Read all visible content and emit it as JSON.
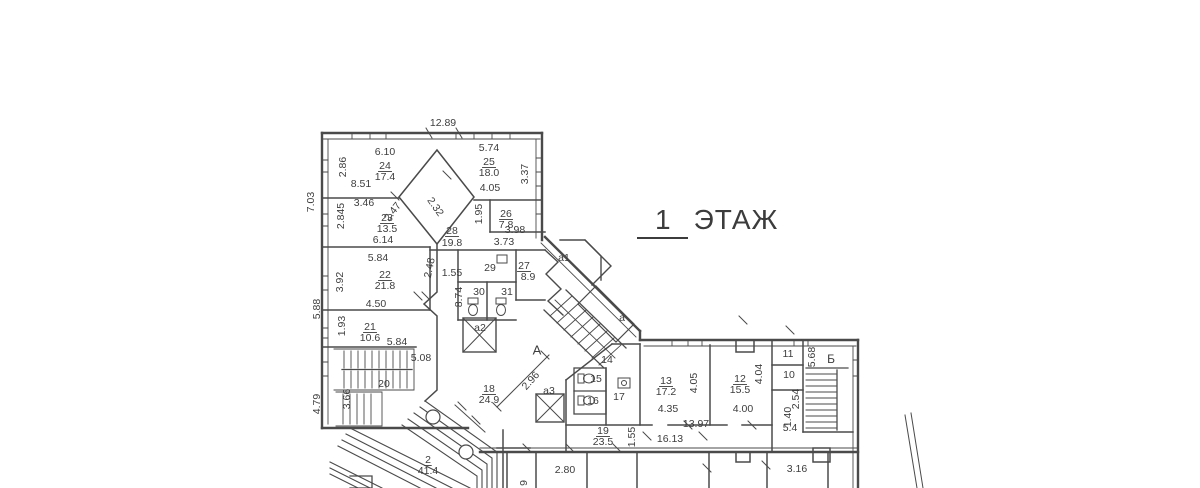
{
  "title": {
    "number": "1",
    "word": "ЭТАЖ"
  },
  "plan": {
    "ink": "#3d3d3d",
    "wall_color": "#4a4a4a",
    "labels": [
      {
        "t": "12.89",
        "x": 443,
        "y": 123
      },
      {
        "t": "6.10",
        "x": 385,
        "y": 152
      },
      {
        "t": "24",
        "x": 385,
        "y": 166,
        "u": 1
      },
      {
        "t": "17.4",
        "x": 385,
        "y": 177
      },
      {
        "t": "2.86",
        "x": 343,
        "y": 167,
        "r": -90
      },
      {
        "t": "8.51",
        "x": 361,
        "y": 184
      },
      {
        "t": "3.46",
        "x": 364,
        "y": 203
      },
      {
        "t": "2.845",
        "x": 341,
        "y": 216,
        "r": -90
      },
      {
        "t": "23",
        "x": 387,
        "y": 218,
        "u": 1
      },
      {
        "t": "13.5",
        "x": 387,
        "y": 229
      },
      {
        "t": "6.14",
        "x": 383,
        "y": 240
      },
      {
        "t": "7.03",
        "x": 311,
        "y": 202,
        "r": -90
      },
      {
        "t": "5.74",
        "x": 489,
        "y": 148
      },
      {
        "t": "25",
        "x": 489,
        "y": 162,
        "u": 1
      },
      {
        "t": "18.0",
        "x": 489,
        "y": 173
      },
      {
        "t": "4.05",
        "x": 490,
        "y": 188
      },
      {
        "t": "3.37",
        "x": 525,
        "y": 174,
        "r": -90
      },
      {
        "t": "2.47",
        "x": 393,
        "y": 212,
        "r": -52
      },
      {
        "t": "2.32",
        "x": 435,
        "y": 207,
        "r": 55
      },
      {
        "t": "1.95",
        "x": 479,
        "y": 214,
        "r": -90
      },
      {
        "t": "26",
        "x": 506,
        "y": 214,
        "u": 1
      },
      {
        "t": "7.8",
        "x": 506,
        "y": 225
      },
      {
        "t": "3.98",
        "x": 515,
        "y": 230
      },
      {
        "t": "28",
        "x": 452,
        "y": 231,
        "u": 1
      },
      {
        "t": "19.8",
        "x": 452,
        "y": 243
      },
      {
        "t": "3.73",
        "x": 504,
        "y": 242
      },
      {
        "t": "5.84",
        "x": 378,
        "y": 258
      },
      {
        "t": "3.92",
        "x": 340,
        "y": 282,
        "r": -90
      },
      {
        "t": "22",
        "x": 385,
        "y": 275,
        "u": 1
      },
      {
        "t": "21.8",
        "x": 385,
        "y": 286
      },
      {
        "t": "2.48",
        "x": 430,
        "y": 268,
        "r": -78
      },
      {
        "t": "1.55",
        "x": 452,
        "y": 273
      },
      {
        "t": "29",
        "x": 490,
        "y": 268
      },
      {
        "t": "27",
        "x": 524,
        "y": 266,
        "u": 1
      },
      {
        "t": "8.9",
        "x": 528,
        "y": 277
      },
      {
        "t": "30",
        "x": 479,
        "y": 292
      },
      {
        "t": "31",
        "x": 507,
        "y": 292
      },
      {
        "t": "8.74",
        "x": 459,
        "y": 297,
        "r": -90
      },
      {
        "t": "а1",
        "x": 564,
        "y": 258
      },
      {
        "t": "4.50",
        "x": 376,
        "y": 304
      },
      {
        "t": "5.88",
        "x": 317,
        "y": 309,
        "r": -90
      },
      {
        "t": "1.93",
        "x": 342,
        "y": 326,
        "r": -90
      },
      {
        "t": "21",
        "x": 370,
        "y": 327,
        "u": 1
      },
      {
        "t": "10.6",
        "x": 370,
        "y": 338
      },
      {
        "t": "5.84",
        "x": 397,
        "y": 342
      },
      {
        "t": "а2",
        "x": 480,
        "y": 328
      },
      {
        "t": "а",
        "x": 622,
        "y": 318
      },
      {
        "t": "А",
        "x": 537,
        "y": 351,
        "s": 13
      },
      {
        "t": "5.08",
        "x": 421,
        "y": 358
      },
      {
        "t": "20",
        "x": 384,
        "y": 384
      },
      {
        "t": "3.66",
        "x": 347,
        "y": 399,
        "r": -90
      },
      {
        "t": "4.79",
        "x": 317,
        "y": 404,
        "r": -90
      },
      {
        "t": "18",
        "x": 489,
        "y": 389,
        "u": 1
      },
      {
        "t": "24.9",
        "x": 489,
        "y": 400
      },
      {
        "t": "2.96",
        "x": 531,
        "y": 381,
        "r": -48
      },
      {
        "t": "14",
        "x": 607,
        "y": 360
      },
      {
        "t": "15",
        "x": 596,
        "y": 379
      },
      {
        "t": "16",
        "x": 593,
        "y": 401
      },
      {
        "t": "17",
        "x": 619,
        "y": 397
      },
      {
        "t": "а3",
        "x": 549,
        "y": 391
      },
      {
        "t": "13",
        "x": 666,
        "y": 381,
        "u": 1
      },
      {
        "t": "17.2",
        "x": 666,
        "y": 392
      },
      {
        "t": "4.05",
        "x": 694,
        "y": 383,
        "r": -90
      },
      {
        "t": "4.35",
        "x": 668,
        "y": 409
      },
      {
        "t": "12",
        "x": 740,
        "y": 379,
        "u": 1
      },
      {
        "t": "15.5",
        "x": 740,
        "y": 390
      },
      {
        "t": "4.04",
        "x": 759,
        "y": 374,
        "r": -90
      },
      {
        "t": "4.00",
        "x": 743,
        "y": 409
      },
      {
        "t": "11",
        "x": 788,
        "y": 354
      },
      {
        "t": "10",
        "x": 789,
        "y": 375
      },
      {
        "t": "5.68",
        "x": 812,
        "y": 357,
        "r": -90
      },
      {
        "t": "Б",
        "x": 831,
        "y": 360,
        "s": 12
      },
      {
        "t": "2.54",
        "x": 796,
        "y": 399,
        "r": -90
      },
      {
        "t": "1.40",
        "x": 788,
        "y": 417,
        "r": -90
      },
      {
        "t": "5.4",
        "x": 790,
        "y": 428
      },
      {
        "t": "19",
        "x": 603,
        "y": 431,
        "u": 1
      },
      {
        "t": "23.5",
        "x": 603,
        "y": 442
      },
      {
        "t": "1.55",
        "x": 632,
        "y": 437,
        "r": -90
      },
      {
        "t": "16.13",
        "x": 670,
        "y": 439
      },
      {
        "t": "13.97",
        "x": 696,
        "y": 424
      },
      {
        "t": "2",
        "x": 428,
        "y": 460,
        "u": 1
      },
      {
        "t": "41.4",
        "x": 428,
        "y": 471
      },
      {
        "t": "2.80",
        "x": 565,
        "y": 470
      },
      {
        "t": "3.16",
        "x": 797,
        "y": 469
      },
      {
        "t": "9",
        "x": 524,
        "y": 483,
        "r": -90
      }
    ]
  }
}
